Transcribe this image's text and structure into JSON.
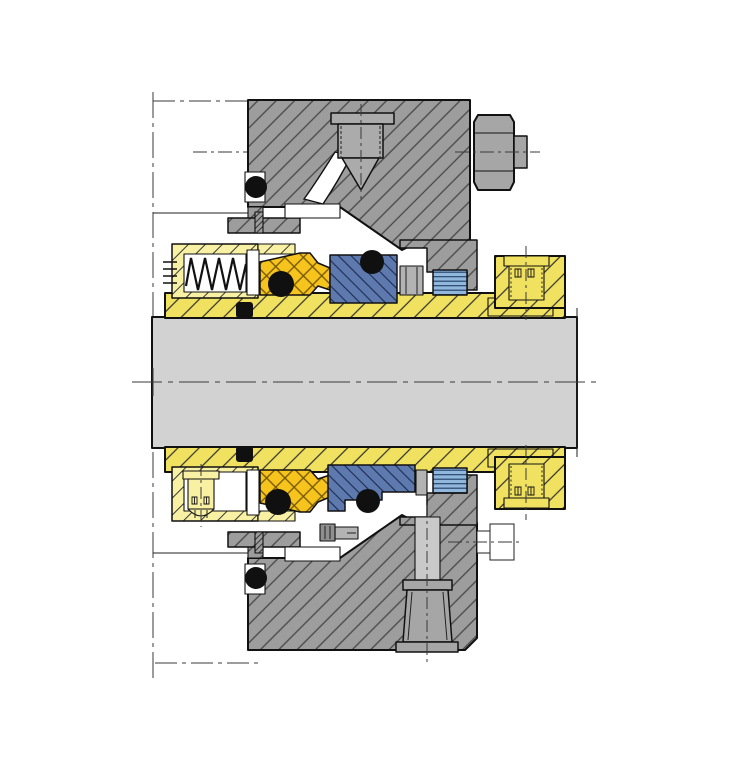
{
  "diagram": {
    "type": "technical-cross-section",
    "subject": "cartridge mechanical shaft seal assembly, axial section view",
    "colors": {
      "background": "#ffffff",
      "outline": "#111111",
      "housing_gray": "#9d9d9d",
      "housing_hatch": "#474747",
      "dense_hatch": "#333333",
      "shaft_gray": "#d2d2d2",
      "steel_light": "#ababab",
      "nut_gray": "#a6a6a6",
      "steel_dark": "#8f8f8f",
      "stud_gray": "#c9c9c9",
      "clamp_gray": "#b3b3b3",
      "sleeve_yellow": "#f0e160",
      "sleeve_hatch": "#2e2e2e",
      "retainer_yellow": "#f8f0a2",
      "retainer_hatch": "#3a3a3a",
      "face_orange": "#f7c31d",
      "face_hatch": "#6e5500",
      "seat_blue": "#5d79ae",
      "seat_hatch": "#1c2c52",
      "gasket_blue": "#92b7dc",
      "gasket_stripe": "#27466e",
      "oring_black": "#101010"
    },
    "components": [
      "pump housing (phantom outline)",
      "seal gland plate - upper section",
      "seal gland plate - lower section",
      "gasket slots",
      "pipe plug",
      "flush passage",
      "gland bolt hex nut",
      "gland bolt (outline view)",
      "gland stud with tapered nut",
      "shaft",
      "shaft sleeve",
      "sleeve O-rings",
      "spring retainer",
      "coil spring",
      "spring follower",
      "primary seal ring (cross-hatched)",
      "dynamic O-rings",
      "stationary seat",
      "seat O-rings",
      "seat clamp spacer",
      "grooved seat gasket",
      "drive collar",
      "drive collar set screws",
      "retainer cap screw",
      "seat clamp screw",
      "anti-rotation pins"
    ]
  }
}
